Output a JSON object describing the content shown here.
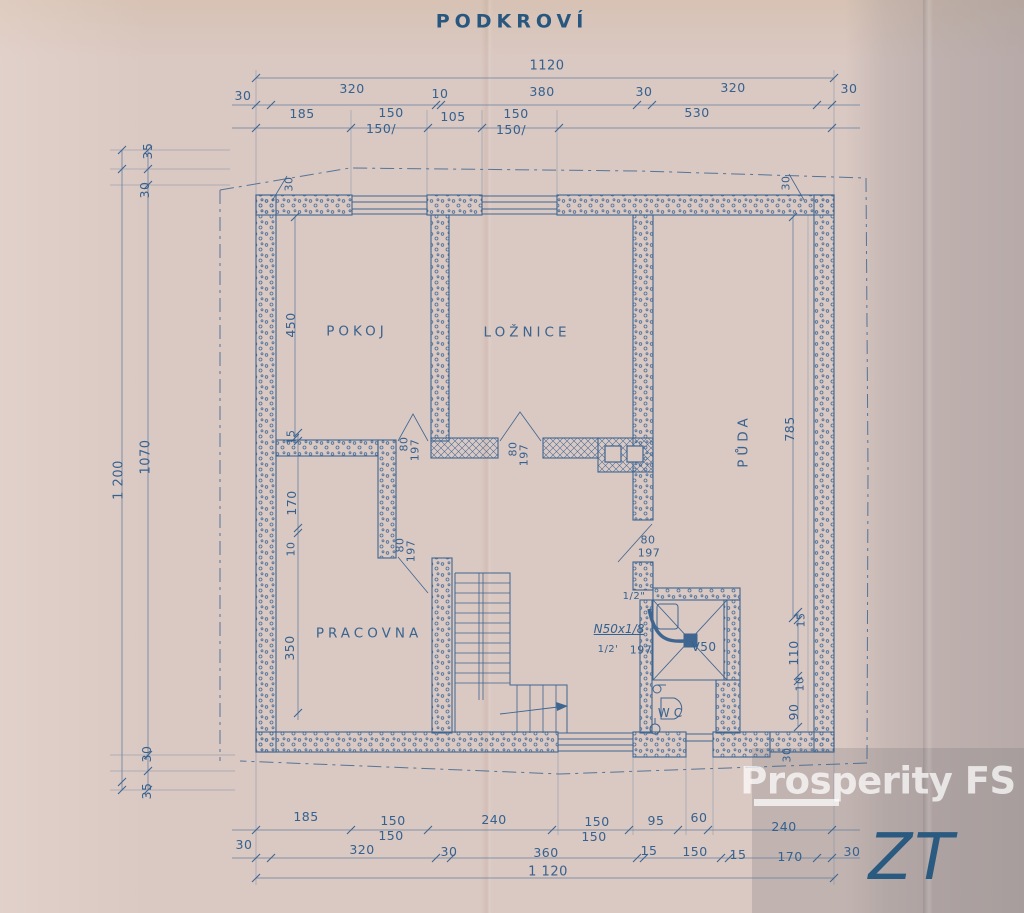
{
  "title": "PODKROVÍ",
  "colors": {
    "paper": "#dac8c2",
    "ink": "#3e6691",
    "ink_dark": "#27567f",
    "gray_band": "#b5aeb0",
    "watermark_white": "#ffffff",
    "zt_mark": "#2a5a80"
  },
  "rooms": [
    {
      "label": "POKOJ"
    },
    {
      "label": "LOŽNICE"
    },
    {
      "label": "PŮDA"
    },
    {
      "label": "PRACOVNA"
    },
    {
      "label": "WC"
    }
  ],
  "watermark": {
    "brand": "Prosperity FS",
    "corner_mark": "ZT"
  },
  "dimensions": {
    "top_overall": "1120",
    "top_row2": [
      "30",
      "320",
      "10",
      "380",
      "30",
      "320",
      "30"
    ],
    "top_row3": [
      "185",
      "150",
      "150/",
      "105",
      "150",
      "150/",
      "530"
    ],
    "left": [
      "35",
      "30",
      "1 200",
      "1070",
      "30",
      "35"
    ],
    "bottom_row1": [
      "185",
      "150",
      "150",
      "240",
      "150",
      "150",
      "95",
      "60",
      "240"
    ],
    "bottom_row2": [
      "30",
      "320",
      "30",
      "360",
      "15",
      "150",
      "15",
      "170",
      "30"
    ],
    "bottom_overall": "1 120",
    "interior": [
      "450",
      "785",
      "15",
      "170",
      "10",
      "350",
      "15",
      "110",
      "10",
      "90",
      "30"
    ],
    "doors": [
      "80",
      "197"
    ],
    "plumbing": [
      "1/2\"",
      "N50x1/8",
      "1/2'",
      "197",
      "V50"
    ]
  },
  "labels": [
    {
      "n": "plan-title",
      "t": "PODKROVÍ",
      "x": 512,
      "y": 22,
      "s": 19,
      "c": "title"
    },
    {
      "n": "dim-top-1120",
      "t": "1120",
      "x": 547,
      "y": 66,
      "s": 13
    },
    {
      "n": "dim-top-30-a",
      "t": "30",
      "x": 243,
      "y": 96
    },
    {
      "n": "dim-top-320-a",
      "t": "320",
      "x": 352,
      "y": 89
    },
    {
      "n": "dim-top-10",
      "t": "10",
      "x": 440,
      "y": 94
    },
    {
      "n": "dim-top-380",
      "t": "380",
      "x": 542,
      "y": 92
    },
    {
      "n": "dim-top-30-b",
      "t": "30",
      "x": 644,
      "y": 92
    },
    {
      "n": "dim-top-320-b",
      "t": "320",
      "x": 733,
      "y": 88
    },
    {
      "n": "dim-top-30-c",
      "t": "30",
      "x": 849,
      "y": 89
    },
    {
      "n": "dim-top-185",
      "t": "185",
      "x": 302,
      "y": 114
    },
    {
      "n": "dim-top-150-a",
      "t": "150",
      "x": 391,
      "y": 113
    },
    {
      "n": "dim-top-150-aj",
      "t": "150/",
      "x": 381,
      "y": 129
    },
    {
      "n": "dim-top-105",
      "t": "105",
      "x": 453,
      "y": 117
    },
    {
      "n": "dim-top-150-b",
      "t": "150",
      "x": 516,
      "y": 114
    },
    {
      "n": "dim-top-150-bj",
      "t": "150/",
      "x": 511,
      "y": 130
    },
    {
      "n": "dim-top-530",
      "t": "530",
      "x": 697,
      "y": 113
    },
    {
      "n": "dim-left-35-top",
      "t": "35",
      "x": 148,
      "y": 151,
      "r": -90
    },
    {
      "n": "dim-left-30-top",
      "t": "30",
      "x": 145,
      "y": 190,
      "r": -90
    },
    {
      "n": "dim-left-1200",
      "t": "1 200",
      "x": 119,
      "y": 480,
      "r": -90,
      "s": 13
    },
    {
      "n": "dim-left-1070",
      "t": "1070",
      "x": 146,
      "y": 457,
      "r": -90,
      "s": 13
    },
    {
      "n": "dim-left-30-bot",
      "t": "30",
      "x": 147,
      "y": 754,
      "r": -90
    },
    {
      "n": "dim-left-35-bot",
      "t": "35",
      "x": 147,
      "y": 791,
      "r": -90
    },
    {
      "n": "dim-wall-30-nw",
      "t": "30",
      "x": 289,
      "y": 184,
      "r": -90,
      "s": 11
    },
    {
      "n": "dim-wall-30-ne",
      "t": "30",
      "x": 786,
      "y": 183,
      "r": -90,
      "s": 11
    },
    {
      "n": "dim-pokoj-450",
      "t": "450",
      "x": 291,
      "y": 325,
      "r": -90
    },
    {
      "n": "room-pokoj",
      "t": "POKOJ",
      "x": 357,
      "y": 332,
      "c": "room"
    },
    {
      "n": "room-loznice",
      "t": "LOŽNICE",
      "x": 527,
      "y": 333,
      "c": "room"
    },
    {
      "n": "room-puda",
      "t": "PŮDA",
      "x": 744,
      "y": 441,
      "r": -90,
      "c": "room"
    },
    {
      "n": "dim-puda-785",
      "t": "785",
      "x": 790,
      "y": 429,
      "r": -90
    },
    {
      "n": "room-pracovna",
      "t": "PRACOVNA",
      "x": 369,
      "y": 634,
      "c": "room"
    },
    {
      "n": "dim-int-15",
      "t": "15",
      "x": 291,
      "y": 437,
      "r": -90,
      "s": 11
    },
    {
      "n": "dim-int-170",
      "t": "170",
      "x": 292,
      "y": 503,
      "r": -90
    },
    {
      "n": "dim-int-10",
      "t": "10",
      "x": 291,
      "y": 549,
      "r": -90,
      "s": 11
    },
    {
      "n": "dim-int-350",
      "t": "350",
      "x": 290,
      "y": 648,
      "r": -90
    },
    {
      "n": "door1-80",
      "t": "80",
      "x": 404,
      "y": 444,
      "r": -90,
      "s": 11
    },
    {
      "n": "door1-197",
      "t": "197",
      "x": 415,
      "y": 450,
      "r": -90,
      "s": 11
    },
    {
      "n": "door2-80",
      "t": "80",
      "x": 513,
      "y": 449,
      "r": -90,
      "s": 11
    },
    {
      "n": "door2-197",
      "t": "197",
      "x": 524,
      "y": 455,
      "r": -90,
      "s": 11
    },
    {
      "n": "door3-80",
      "t": "80",
      "x": 400,
      "y": 545,
      "r": -90,
      "s": 11
    },
    {
      "n": "door3-197",
      "t": "197",
      "x": 411,
      "y": 551,
      "r": -90,
      "s": 11
    },
    {
      "n": "door4-80",
      "t": "80",
      "x": 648,
      "y": 540,
      "s": 11
    },
    {
      "n": "door4-197",
      "t": "197",
      "x": 649,
      "y": 553,
      "s": 11
    },
    {
      "n": "pipe-half-a",
      "t": "1/2\"",
      "x": 634,
      "y": 597,
      "s": 10
    },
    {
      "n": "pipe-n50",
      "t": "N50x1/8",
      "x": 619,
      "y": 629,
      "s": 12,
      "c": "pipe"
    },
    {
      "n": "pipe-half-b",
      "t": "1/2'",
      "x": 608,
      "y": 650,
      "s": 10
    },
    {
      "n": "pipe-197",
      "t": "197",
      "x": 641,
      "y": 650,
      "s": 11
    },
    {
      "n": "fixture-v50",
      "t": "V50",
      "x": 704,
      "y": 647,
      "s": 12
    },
    {
      "n": "room-wc",
      "t": "WC",
      "x": 672,
      "y": 713,
      "s": 12,
      "c": "room"
    },
    {
      "n": "dim-right-15",
      "t": "15",
      "x": 801,
      "y": 620,
      "r": -90,
      "s": 11
    },
    {
      "n": "dim-right-110",
      "t": "110",
      "x": 794,
      "y": 653,
      "r": -90
    },
    {
      "n": "dim-right-10",
      "t": "10",
      "x": 800,
      "y": 684,
      "r": -90,
      "s": 11
    },
    {
      "n": "dim-right-90",
      "t": "90",
      "x": 794,
      "y": 712,
      "r": -90
    },
    {
      "n": "dim-right-30",
      "t": "30",
      "x": 787,
      "y": 755,
      "r": -90,
      "s": 11
    },
    {
      "n": "dim-bot-185",
      "t": "185",
      "x": 306,
      "y": 817
    },
    {
      "n": "dim-bot-150-a",
      "t": "150",
      "x": 393,
      "y": 821
    },
    {
      "n": "dim-bot-150-aj",
      "t": "150",
      "x": 391,
      "y": 836
    },
    {
      "n": "dim-bot-240-a",
      "t": "240",
      "x": 494,
      "y": 820
    },
    {
      "n": "dim-bot-150-b",
      "t": "150",
      "x": 597,
      "y": 822
    },
    {
      "n": "dim-bot-150-bj",
      "t": "150",
      "x": 594,
      "y": 837
    },
    {
      "n": "dim-bot-95",
      "t": "95",
      "x": 656,
      "y": 821
    },
    {
      "n": "dim-bot-60",
      "t": "60",
      "x": 699,
      "y": 818
    },
    {
      "n": "dim-bot-240-b",
      "t": "240",
      "x": 784,
      "y": 827
    },
    {
      "n": "dim-bot-30-a",
      "t": "30",
      "x": 244,
      "y": 845
    },
    {
      "n": "dim-bot-320",
      "t": "320",
      "x": 362,
      "y": 850
    },
    {
      "n": "dim-bot-30-b",
      "t": "30",
      "x": 449,
      "y": 852
    },
    {
      "n": "dim-bot-360",
      "t": "360",
      "x": 546,
      "y": 853
    },
    {
      "n": "dim-bot-15-a",
      "t": "15",
      "x": 649,
      "y": 851
    },
    {
      "n": "dim-bot-150-c",
      "t": "150",
      "x": 695,
      "y": 852
    },
    {
      "n": "dim-bot-15-b",
      "t": "15",
      "x": 738,
      "y": 855
    },
    {
      "n": "dim-bot-170",
      "t": "170",
      "x": 790,
      "y": 857
    },
    {
      "n": "dim-bot-30-c",
      "t": "30",
      "x": 852,
      "y": 852
    },
    {
      "n": "dim-bot-1120",
      "t": "1 120",
      "x": 548,
      "y": 872,
      "s": 13
    },
    {
      "n": "watermark-brand",
      "t": "Prosperity FS",
      "x": 878,
      "y": 781,
      "c": "wm"
    },
    {
      "n": "zt-mark",
      "t": "ZT",
      "x": 912,
      "y": 858,
      "c": "zt"
    }
  ]
}
